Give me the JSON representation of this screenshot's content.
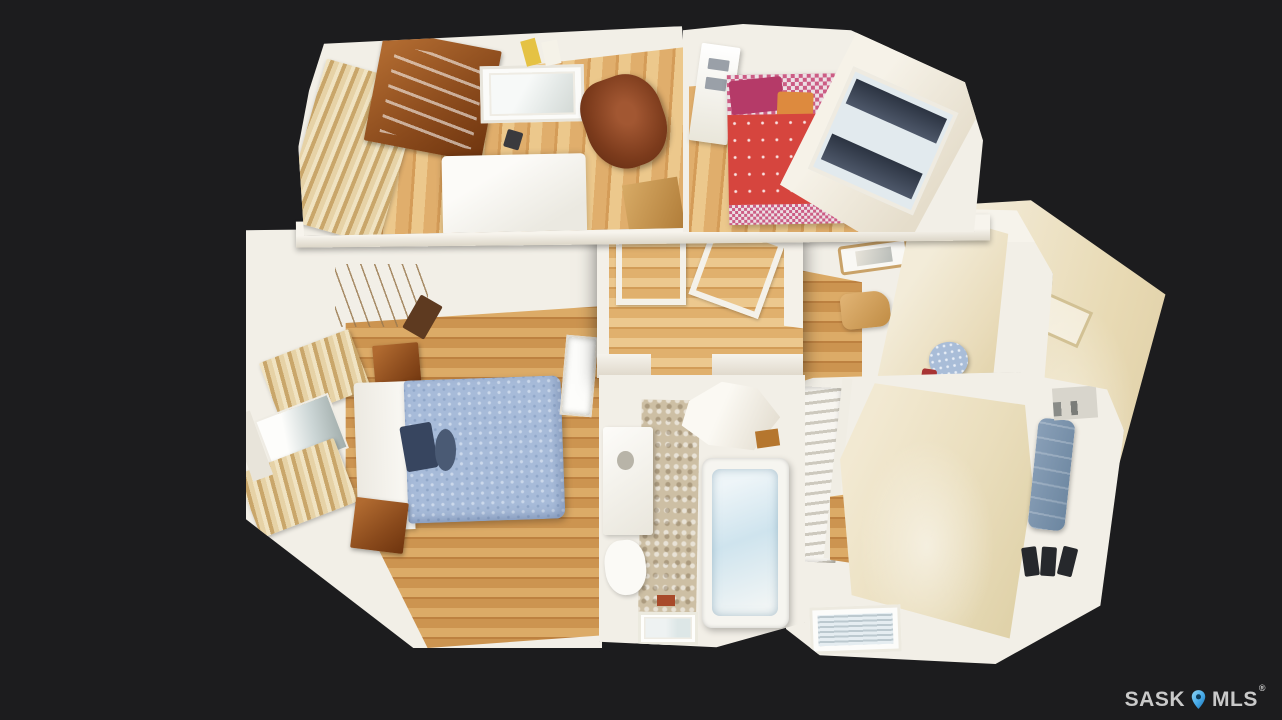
{
  "watermark": {
    "brand_left": "SASK",
    "brand_right": "MLS",
    "registered_mark": "®"
  },
  "icons": {
    "watermark_pin": "map-pin"
  },
  "palette": {
    "background": "#1c1c1e",
    "wall": "#f2efe7",
    "wall_shade": "#dcd6c8",
    "wood_floor": "#cc9450",
    "wood_floor_dark": "#bd8140",
    "wood_floor_light": "#dcab67",
    "cream_slope": "#eadebd",
    "curtain_tan": "#c9a66a",
    "bed_white": "#fcfbf8",
    "bed_blue": "#a7bbd9",
    "bed_blue_dot": "#ccd9eb",
    "bed_red": "#d6453e",
    "pillow_pink": "#cc5c84",
    "pillow_magenta": "#b53a68",
    "pillow_orange": "#dd8a3e",
    "armchair_brown": "#7c3b1c",
    "furniture_wood": "#8a4a1c",
    "blinds_navy": "#2c3442",
    "tub_blue": "#cfe4ee",
    "rug_beige": "#cdbfa4",
    "couch_denim": "#6c86a0",
    "pin_blue": "#45a9e8",
    "pin_blue_dark": "#0d3d5c",
    "watermark_text": "#c9c9c9"
  }
}
